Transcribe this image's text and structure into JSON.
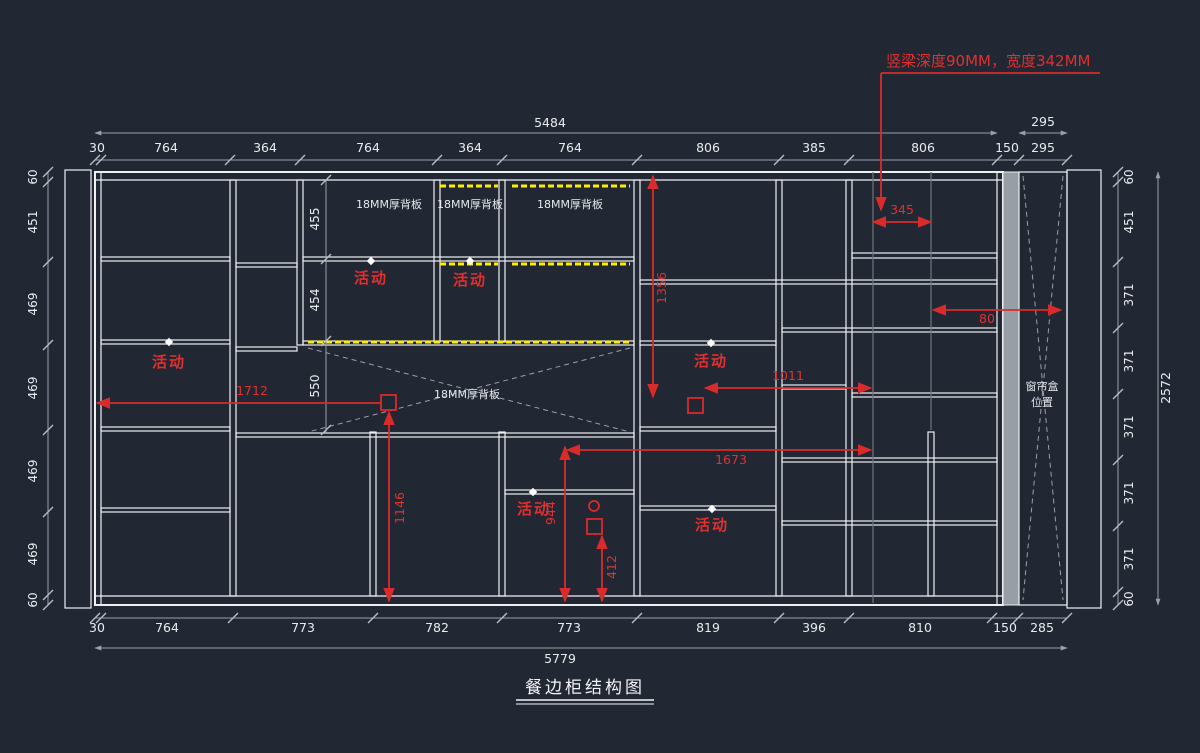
{
  "drawing": {
    "title": "餐边柜结构图",
    "callout": "竖梁深度90MM，宽度342MM"
  },
  "labels": {
    "backboard": "18MM厚背板",
    "movable": "活动",
    "curtain_line1": "窗帘盒",
    "curtain_line2": "位置"
  },
  "dims": {
    "top_total": "5484",
    "top_curtain_total": "295",
    "top_segments": [
      "30",
      "764",
      "364",
      "764",
      "364",
      "764",
      "806",
      "385",
      "806",
      "150",
      "295"
    ],
    "bottom_segments": [
      "30",
      "764",
      "773",
      "782",
      "773",
      "819",
      "396",
      "810",
      "150",
      "285"
    ],
    "bottom_total": "5779",
    "left_segments": [
      "60",
      "451",
      "469",
      "469",
      "469",
      "469",
      "60"
    ],
    "right_segments": [
      "60",
      "451",
      "371",
      "371",
      "371",
      "371",
      "371",
      "60"
    ],
    "right_total": "2572",
    "inner_heights": [
      "455",
      "454",
      "550"
    ],
    "red": {
      "beam_span": "345",
      "h1356": "1356",
      "w1011": "1011",
      "w80": "80",
      "w1712": "1712",
      "h1146": "1146",
      "h944": "944",
      "w1673": "1673",
      "h412": "412"
    }
  },
  "colors": {
    "background": "#212733",
    "line_white": "#eef0f2",
    "dim_gray": "#9aa0a8",
    "annotation_red": "#d92b2b",
    "hatch_yellow": "#ffee00",
    "pelmet_gray": "#989ea6"
  }
}
